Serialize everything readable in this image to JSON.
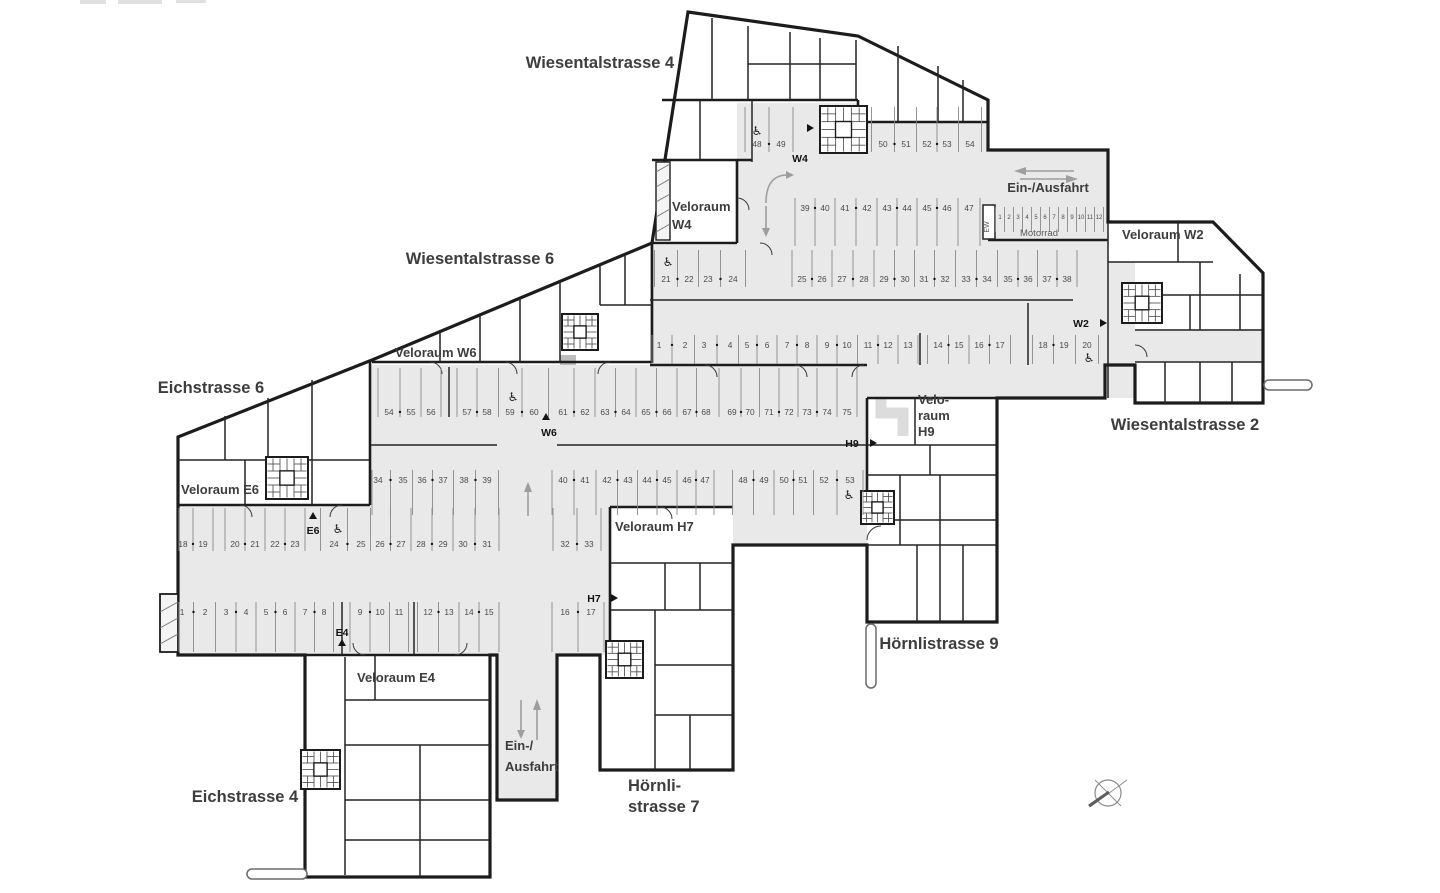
{
  "colors": {
    "wall": "#1c1c1c",
    "deck_fill": "#e9e9e9",
    "stall_line": "#8a8a8a",
    "stall_number": "#4a4a4a",
    "label_text": "#3d3d3d",
    "arrow_gray": "#9e9e9e",
    "marker_black": "#141414"
  },
  "street_labels": [
    {
      "text": "Wiesentalstrasse 4",
      "x": 600,
      "y": 68,
      "anchor": "middle"
    },
    {
      "text": "Wiesentalstrasse 6",
      "x": 480,
      "y": 264,
      "anchor": "middle"
    },
    {
      "text": "Wiesentalstrasse 2",
      "x": 1185,
      "y": 430,
      "anchor": "middle"
    },
    {
      "text": "Eichstrasse 6",
      "x": 211,
      "y": 393,
      "anchor": "middle"
    },
    {
      "text": "Eichstrasse 4",
      "x": 245,
      "y": 802,
      "anchor": "middle"
    },
    {
      "text": "Hörnlistrasse 9",
      "x": 939,
      "y": 649,
      "anchor": "middle"
    },
    {
      "lines": [
        "Hörnli-",
        "strasse 7"
      ],
      "x": 628,
      "y": 791,
      "lh": 21,
      "anchor": "start"
    }
  ],
  "room_labels": [
    {
      "lines": [
        "Veloraum",
        "W4"
      ],
      "x": 672,
      "y": 211,
      "lh": 18,
      "anchor": "start"
    },
    {
      "text": "Veloraum W6",
      "x": 395,
      "y": 357,
      "anchor": "start"
    },
    {
      "text": "Veloraum W2",
      "x": 1122,
      "y": 239,
      "anchor": "start"
    },
    {
      "text": "Veloraum E6",
      "x": 181,
      "y": 494,
      "anchor": "start"
    },
    {
      "text": "Veloraum E4",
      "x": 357,
      "y": 682,
      "anchor": "start"
    },
    {
      "text": "Veloraum H7",
      "x": 615,
      "y": 531,
      "anchor": "start"
    },
    {
      "lines": [
        "Velo-",
        "raum",
        "H9"
      ],
      "x": 918,
      "y": 404,
      "lh": 16,
      "anchor": "start"
    }
  ],
  "flow_labels": [
    {
      "text": "Ein-/Ausfahrt",
      "x": 1048,
      "y": 192,
      "fs": 13,
      "anchor": "middle"
    },
    {
      "lines": [
        "Ein-/",
        "Ausfahrt"
      ],
      "x": 505,
      "y": 750,
      "lh": 21,
      "fs": 13,
      "anchor": "start"
    },
    {
      "text": "Motorrad",
      "x": 1039,
      "y": 236,
      "fs": 9.5,
      "anchor": "middle",
      "light": true
    },
    {
      "text": "EW",
      "x": 989,
      "y": 227,
      "fs": 7,
      "anchor": "middle",
      "rotate": -90,
      "light": true
    }
  ],
  "entry_markers": [
    {
      "text": "W4",
      "x": 800,
      "y": 162,
      "tri": [
        807,
        128,
        "right"
      ]
    },
    {
      "text": "W2",
      "x": 1081,
      "y": 327,
      "tri": [
        1100,
        323,
        "right"
      ]
    },
    {
      "text": "W6",
      "x": 549,
      "y": 436,
      "tri": [
        546,
        420,
        "up"
      ]
    },
    {
      "text": "E6",
      "x": 313,
      "y": 534,
      "tri": [
        313,
        519,
        "up"
      ]
    },
    {
      "text": "E4",
      "x": 342,
      "y": 636,
      "tri": [
        342,
        646,
        "up"
      ]
    },
    {
      "text": "H7",
      "x": 594,
      "y": 602,
      "tri": [
        611,
        598,
        "right"
      ]
    },
    {
      "text": "H9",
      "x": 852,
      "y": 447,
      "tri": [
        870,
        443,
        "right"
      ]
    }
  ],
  "parking_rows": [
    {
      "nums": [
        48,
        49
      ],
      "xs": [
        757,
        781
      ],
      "ty": 147,
      "y1": 107,
      "y2": 152
    },
    {
      "nums": [
        50,
        51,
        52,
        53,
        54
      ],
      "xs": [
        883,
        906,
        927,
        947,
        970
      ],
      "ty": 147,
      "y1": 107,
      "y2": 152
    },
    {
      "nums": [
        39,
        40,
        41,
        42,
        43,
        44,
        45,
        46,
        47
      ],
      "xs": [
        805,
        825,
        845,
        867,
        887,
        907,
        927,
        947,
        969
      ],
      "ty": 211,
      "y1": 198,
      "y2": 246
    },
    {
      "nums": [
        1,
        2,
        3,
        4,
        5,
        6,
        7,
        8,
        9,
        10,
        11,
        12
      ],
      "xs": [
        1000,
        1009,
        1018,
        1027,
        1036,
        1045,
        1054,
        1063,
        1072,
        1081,
        1090,
        1099
      ],
      "ty": 219,
      "y1": 207,
      "y2": 232,
      "fs": 6,
      "dots": false
    },
    {
      "nums": [
        21,
        22,
        23,
        24
      ],
      "xs": [
        666,
        689,
        708,
        733
      ],
      "ty": 282,
      "y1": 250,
      "y2": 287,
      "x0": 654
    },
    {
      "nums": [
        25,
        26,
        27,
        28,
        29,
        30,
        31,
        32,
        33,
        34,
        35,
        36,
        37,
        38
      ],
      "xs": [
        802,
        822,
        842,
        864,
        884,
        905,
        924,
        945,
        966,
        987,
        1008,
        1028,
        1047,
        1067
      ],
      "ty": 282,
      "y1": 250,
      "y2": 287
    },
    {
      "nums": [
        1,
        2,
        3,
        4,
        5,
        6,
        7,
        8,
        9,
        10,
        11,
        12,
        13
      ],
      "xs": [
        659,
        685,
        704,
        730,
        747,
        767,
        787,
        807,
        827,
        847,
        868,
        888,
        908
      ],
      "ty": 348,
      "y1": 335,
      "y2": 364,
      "x0": 652
    },
    {
      "nums": [
        14,
        15,
        16,
        17
      ],
      "xs": [
        938,
        959,
        979,
        1000
      ],
      "ty": 348,
      "y1": 335,
      "y2": 364
    },
    {
      "nums": [
        18,
        19,
        20
      ],
      "xs": [
        1043,
        1064,
        1087
      ],
      "ty": 348,
      "y1": 335,
      "y2": 364
    },
    {
      "nums": [
        54,
        55,
        56
      ],
      "xs": [
        389,
        411,
        431
      ],
      "ty": 415,
      "y1": 368,
      "y2": 417,
      "x0": 372
    },
    {
      "nums": [
        57,
        58,
        59,
        60,
        61,
        62,
        63,
        64,
        65,
        66,
        67,
        68,
        69,
        70,
        71,
        72,
        73,
        74,
        75
      ],
      "xs": [
        467,
        487,
        510,
        534,
        563,
        585,
        605,
        626,
        646,
        667,
        687,
        706,
        732,
        750,
        769,
        789,
        807,
        827,
        847
      ],
      "ty": 415,
      "y1": 368,
      "y2": 417
    },
    {
      "nums": [
        34,
        35,
        36,
        37,
        38,
        39
      ],
      "xs": [
        378,
        403,
        422,
        443,
        464,
        487
      ],
      "ty": 483,
      "y1": 470,
      "y2": 515,
      "x0": 372
    },
    {
      "nums": [
        40,
        41,
        42,
        43,
        44,
        45,
        46,
        47
      ],
      "xs": [
        563,
        585,
        607,
        628,
        647,
        667,
        687,
        705
      ],
      "ty": 483,
      "y1": 470,
      "y2": 515
    },
    {
      "nums": [
        48,
        49,
        50,
        51,
        52,
        53
      ],
      "xs": [
        743,
        764,
        784,
        803,
        824,
        850
      ],
      "ty": 483,
      "y1": 470,
      "y2": 515
    },
    {
      "nums": [
        18,
        19
      ],
      "xs": [
        183,
        203
      ],
      "ty": 547,
      "y1": 508,
      "y2": 551,
      "x0": 179
    },
    {
      "nums": [
        20,
        21,
        22,
        23
      ],
      "xs": [
        235,
        255,
        275,
        295
      ],
      "ty": 547,
      "y1": 508,
      "y2": 551
    },
    {
      "nums": [
        24,
        25,
        26,
        27,
        28,
        29,
        30,
        31
      ],
      "xs": [
        334,
        361,
        380,
        401,
        421,
        443,
        463,
        487
      ],
      "ty": 547,
      "y1": 508,
      "y2": 551
    },
    {
      "nums": [
        32,
        33
      ],
      "xs": [
        565,
        589
      ],
      "ty": 547,
      "y1": 508,
      "y2": 551
    },
    {
      "nums": [
        1,
        2,
        3,
        4,
        5,
        6,
        7,
        8
      ],
      "xs": [
        182,
        205,
        226,
        246,
        266,
        285,
        305,
        324
      ],
      "ty": 615,
      "y1": 602,
      "y2": 652,
      "x0": 179
    },
    {
      "nums": [
        9,
        10,
        11
      ],
      "xs": [
        360,
        380,
        399
      ],
      "ty": 615,
      "y1": 602,
      "y2": 652
    },
    {
      "nums": [
        12,
        13,
        14,
        15
      ],
      "xs": [
        428,
        449,
        469,
        489
      ],
      "ty": 615,
      "y1": 602,
      "y2": 652
    },
    {
      "nums": [
        16,
        17
      ],
      "xs": [
        565,
        591
      ],
      "ty": 615,
      "y1": 602,
      "y2": 652
    }
  ],
  "accessible_icons": [
    {
      "x": 757,
      "y": 135
    },
    {
      "x": 668,
      "y": 266
    },
    {
      "x": 513,
      "y": 401
    },
    {
      "x": 1089,
      "y": 362
    },
    {
      "x": 849,
      "y": 499
    },
    {
      "x": 338,
      "y": 533
    }
  ],
  "stairs": [
    {
      "x": 820,
      "y": 106,
      "s": 47
    },
    {
      "x": 562,
      "y": 314,
      "s": 36
    },
    {
      "x": 1122,
      "y": 283,
      "s": 40
    },
    {
      "x": 266,
      "y": 457,
      "s": 42
    },
    {
      "x": 301,
      "y": 750,
      "s": 39
    },
    {
      "x": 606,
      "y": 641,
      "s": 37
    },
    {
      "x": 861,
      "y": 491,
      "s": 33
    }
  ],
  "compass": {
    "x": 1108,
    "y": 793,
    "r": 13
  }
}
